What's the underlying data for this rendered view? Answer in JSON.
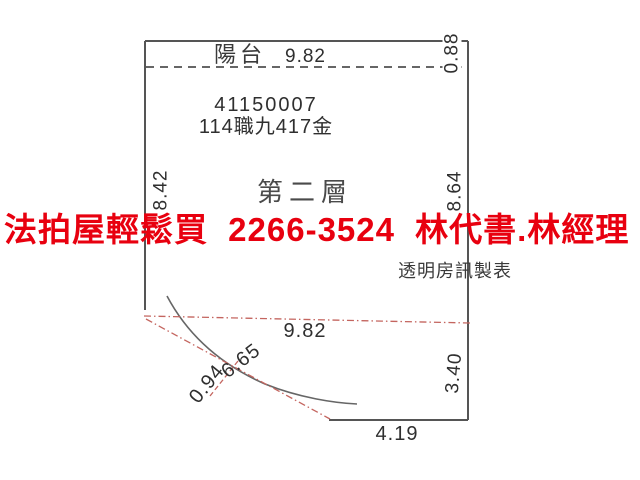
{
  "document": {
    "type": "auction-house-floor-plan-scan"
  },
  "colors": {
    "background": "#ffffff",
    "outline": "#555555",
    "curve": "#666666",
    "dashed_line": "#333333",
    "red_dimension": "#c4655f",
    "watermark_red": "#e8000f",
    "text": "#2f2f2f"
  },
  "plan": {
    "balcony_label": "陽台",
    "balcony_width": "9.82",
    "balcony_depth": "0.88",
    "case_number": "41150007",
    "case_name": "114職九417金",
    "left_dimension": "8.42",
    "floor_label": "第二層",
    "right_dimension": "8.64",
    "bottom_width": "9.82",
    "curve_dimension": "6.65",
    "small_dimension": "0.94",
    "right_lower_dimension": "3.40",
    "bottom_dimension": "4.19"
  },
  "watermark": {
    "text": "法拍屋輕鬆買 2266-3524 林代書.林經理",
    "agency": "法拍屋輕鬆買",
    "phone": "2266-3524",
    "contacts": "林代書.林經理"
  },
  "credit": {
    "maker": "透明房訊製表"
  }
}
